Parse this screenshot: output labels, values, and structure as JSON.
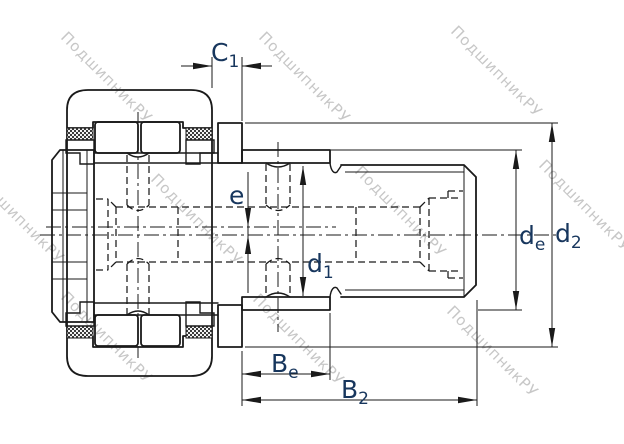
{
  "drawing": {
    "background": "#ffffff",
    "line_color": "#1a1a1a",
    "label_color": "#17365d",
    "watermark_color": "#c1c1c1"
  },
  "watermark": {
    "text": "ПодшипникРУ"
  },
  "dimensions": {
    "c1": {
      "base": "C",
      "sub": "1"
    },
    "e": {
      "base": "e",
      "sub": ""
    },
    "d1": {
      "base": "d",
      "sub": "1"
    },
    "de": {
      "base": "d",
      "sub": "e"
    },
    "d2": {
      "base": "d",
      "sub": "2"
    },
    "be": {
      "base": "B",
      "sub": "e"
    },
    "b2": {
      "base": "B",
      "sub": "2"
    }
  }
}
